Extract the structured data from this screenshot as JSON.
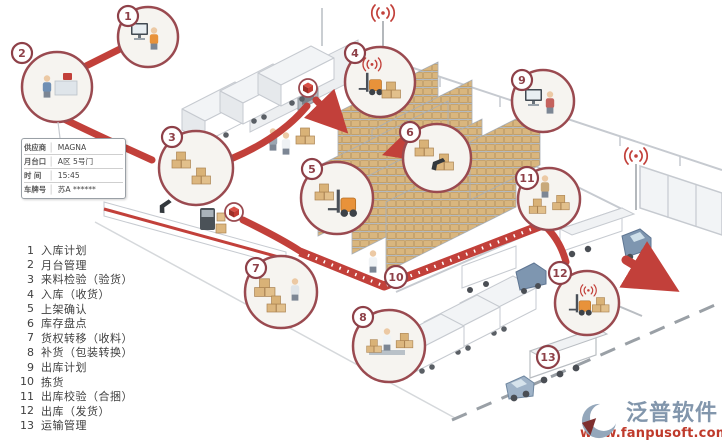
{
  "steps": [
    {
      "num": "1",
      "label": "入库计划"
    },
    {
      "num": "2",
      "label": "月台管理"
    },
    {
      "num": "3",
      "label": "来料检验（验货）"
    },
    {
      "num": "4",
      "label": "入库（收货）"
    },
    {
      "num": "5",
      "label": "上架确认"
    },
    {
      "num": "6",
      "label": "库存盘点"
    },
    {
      "num": "7",
      "label": "货权转移（收料）"
    },
    {
      "num": "8",
      "label": "补货（包装转换）"
    },
    {
      "num": "9",
      "label": "出库计划"
    },
    {
      "num": "10",
      "label": "拣货"
    },
    {
      "num": "11",
      "label": "出库校验（合捆）"
    },
    {
      "num": "12",
      "label": "出库（发货）"
    },
    {
      "num": "13",
      "label": "运输管理"
    }
  ],
  "dock_card": {
    "rows": [
      {
        "label": "供应商",
        "value": "MAGNA"
      },
      {
        "label": "月台口",
        "value": "A区 5号门"
      },
      {
        "label": "时 间",
        "value": "15:45"
      },
      {
        "label": "车牌号",
        "value": "苏A ******"
      }
    ]
  },
  "logo": {
    "name": "泛普软件",
    "url": "www.fanpusoft.com"
  },
  "colors": {
    "flow_red": "#c2403a",
    "badge_ring": "#8e4048",
    "box_tan": "#dcb67e",
    "legend_text": "#3f3f3f",
    "logo_blue": "#8296ac",
    "logo_red": "#bf3a2b",
    "truck_cab": "#7e96b0",
    "forklift_orange": "#e8923a"
  },
  "icons": {
    "wifi": "wifi-signal-icon",
    "cube": "package-cube-icon",
    "arrow": "flow-arrow-icon"
  }
}
